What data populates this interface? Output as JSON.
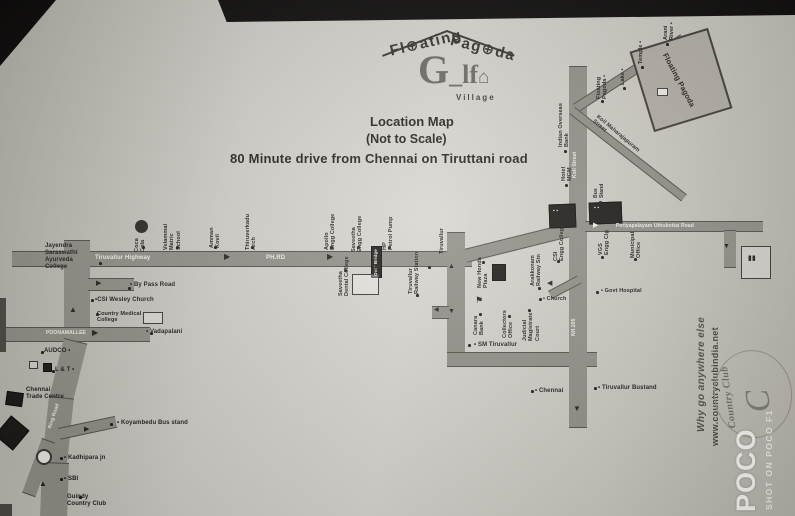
{
  "photo": {
    "watermark_big": "POCO",
    "watermark_small": "SHOT ON POCO F1"
  },
  "header": {
    "brand_word1": "Fl⊕ating",
    "brand_word2": "Pag⊕da",
    "logo_g": "G",
    "logo_underscore": "_",
    "logo_lf": "lf",
    "logo_house": "⌂",
    "logo_village": "Village",
    "title": "Location Map",
    "scale_note": "(Not to Scale)",
    "subtitle": "80 Minute drive from Chennai on Tiruttani road"
  },
  "promo": {
    "tagline": "Why go anywhere else",
    "website": "www.countryclubindia.net",
    "logo_swirl": "C",
    "logo_name": "Country Club"
  },
  "map": {
    "roads": [
      [
        12,
        251,
        460,
        16,
        0
      ],
      [
        464,
        249,
        120,
        14,
        -14
      ],
      [
        64,
        240,
        26,
        102,
        0
      ],
      [
        88,
        278,
        46,
        13,
        0
      ],
      [
        0,
        327,
        150,
        15,
        0
      ],
      [
        64,
        338,
        24,
        62,
        14
      ],
      [
        49,
        396,
        25,
        68,
        6
      ],
      [
        42,
        462,
        27,
        56,
        2
      ],
      [
        42,
        438,
        14,
        58,
        20
      ],
      [
        58,
        428,
        58,
        12,
        -12
      ],
      [
        447,
        232,
        18,
        122,
        0
      ],
      [
        447,
        352,
        150,
        15,
        0
      ],
      [
        569,
        66,
        18,
        362,
        0
      ],
      [
        585,
        221,
        178,
        11,
        0
      ],
      [
        573,
        104,
        128,
        10,
        -33
      ],
      [
        575,
        107,
        142,
        9,
        38
      ],
      [
        724,
        230,
        12,
        38,
        0
      ],
      [
        432,
        306,
        17,
        13,
        0
      ],
      [
        548,
        291,
        33,
        9,
        -28
      ]
    ],
    "shapes": [
      [
        549,
        204,
        27,
        24,
        "s-dark",
        -2
      ],
      [
        589,
        202,
        33,
        22,
        "s-dark",
        -2
      ],
      [
        135,
        220,
        13,
        13,
        "s-circledark",
        0
      ],
      [
        640,
        38,
        82,
        84,
        "s-site",
        -17
      ],
      [
        657,
        88,
        11,
        8,
        "s-white",
        0
      ],
      [
        371,
        246,
        11,
        32,
        "s-dark",
        0
      ],
      [
        352,
        274,
        27,
        21,
        "s-outline",
        0
      ],
      [
        492,
        264,
        14,
        17,
        "s-dark",
        0
      ],
      [
        6,
        392,
        17,
        14,
        "s-dark",
        8
      ],
      [
        741,
        246,
        30,
        33,
        "s-outline",
        0
      ],
      [
        29,
        361,
        9,
        8,
        "s-outline",
        0
      ],
      [
        43,
        363,
        9,
        9,
        "s-dark",
        0
      ],
      [
        36,
        449,
        16,
        16,
        "s-circle",
        0
      ],
      [
        143,
        312,
        20,
        12,
        "s-outline",
        0
      ],
      [
        0,
        298,
        6,
        54,
        "s-dim",
        0
      ],
      [
        0,
        420,
        24,
        26,
        "s-dark",
        40
      ],
      [
        0,
        504,
        12,
        12,
        "s-dim",
        0
      ]
    ],
    "labels": [
      {
        "t": "Tiruvallur Highway",
        "x": 95,
        "y": 255,
        "s": 6,
        "c": "wt"
      },
      {
        "t": "PH.RD",
        "x": 266,
        "y": 255,
        "s": 6,
        "c": "wt"
      },
      {
        "t": "POONAMALLEE",
        "x": 46,
        "y": 331,
        "s": 5,
        "c": "wt"
      },
      {
        "t": "Ring Road",
        "x": 48,
        "y": 428,
        "r": -72,
        "s": 5,
        "c": "wt"
      },
      {
        "t": "Koil Street",
        "x": 573,
        "y": 178,
        "r": -90,
        "s": 5,
        "c": "wt"
      },
      {
        "t": "NH.205",
        "x": 572,
        "y": 336,
        "r": -90,
        "s": 5,
        "c": "wt"
      },
      {
        "t": "Periyapalayam Uthukottai Road",
        "x": 616,
        "y": 224,
        "s": 5,
        "c": "wt"
      },
      {
        "t": "Over Bridge",
        "x": 373,
        "y": 276,
        "r": -90,
        "s": 4.5,
        "c": "wt"
      },
      {
        "t": "Jayendra\nSaraswathi\nAyurveda\nCollege",
        "x": 45,
        "y": 243,
        "s": 6
      },
      {
        "t": "• By Pass Road",
        "x": 130,
        "y": 282,
        "s": 6
      },
      {
        "t": "•CSI Wesley Church",
        "x": 95,
        "y": 297,
        "s": 6
      },
      {
        "t": "Country Medical\nCollege",
        "x": 97,
        "y": 311,
        "s": 5.5
      },
      {
        "t": "• Vadapalani",
        "x": 146,
        "y": 329,
        "s": 6
      },
      {
        "t": "AUDCO •",
        "x": 44,
        "y": 348,
        "s": 6
      },
      {
        "t": "L & T •",
        "x": 55,
        "y": 367,
        "s": 6
      },
      {
        "t": "Chennai\nTrade Centre",
        "x": 26,
        "y": 387,
        "s": 6
      },
      {
        "t": "• Koyambedu Bus stand",
        "x": 117,
        "y": 420,
        "s": 6
      },
      {
        "t": "• Kadhipara jn",
        "x": 64,
        "y": 455,
        "s": 6
      },
      {
        "t": "• SBI",
        "x": 64,
        "y": 476,
        "s": 6
      },
      {
        "t": "Guindy\nCountry Club",
        "x": 67,
        "y": 494,
        "s": 6
      },
      {
        "t": "Coca\nCola",
        "x": 134,
        "y": 252,
        "r": -90,
        "s": 5.5
      },
      {
        "t": "Velammal\nMatric\nSchool",
        "x": 163,
        "y": 250,
        "r": -90,
        "s": 5.5
      },
      {
        "t": "Amman\nKovil",
        "x": 209,
        "y": 248,
        "r": -90,
        "s": 5.5
      },
      {
        "t": "Thiruverkadu\nArch",
        "x": 245,
        "y": 250,
        "r": -90,
        "s": 5.5
      },
      {
        "t": "Apollo\nEngg College",
        "x": 324,
        "y": 250,
        "r": -90,
        "s": 5.5
      },
      {
        "t": "Saveetha\nEngg College",
        "x": 351,
        "y": 252,
        "r": -90,
        "s": 5.5
      },
      {
        "t": "HP\nPetrol Pump",
        "x": 382,
        "y": 250,
        "r": -90,
        "s": 5.5
      },
      {
        "t": "Saveetha\nDental College",
        "x": 338,
        "y": 296,
        "r": -90,
        "s": 5.5
      },
      {
        "t": "Tiruvallur\nRailway Station",
        "x": 408,
        "y": 294,
        "r": -90,
        "s": 5.5
      },
      {
        "t": "Tiruvallur",
        "x": 439,
        "y": 254,
        "r": -90,
        "s": 5.5
      },
      {
        "t": "New Honda\nPlaza",
        "x": 477,
        "y": 288,
        "r": -90,
        "s": 5.5
      },
      {
        "t": "Canara\nBank",
        "x": 473,
        "y": 335,
        "r": -90,
        "s": 5.5
      },
      {
        "t": "Collectors\nOffice",
        "x": 502,
        "y": 338,
        "r": -90,
        "s": 5.5
      },
      {
        "t": "Judicial\nMagistrate\nCourt",
        "x": 522,
        "y": 341,
        "r": -90,
        "s": 5.5
      },
      {
        "t": "Arakkonam\nRailway Stn",
        "x": 530,
        "y": 286,
        "r": -90,
        "s": 5.5
      },
      {
        "t": "CSI\nEngg College",
        "x": 553,
        "y": 261,
        "r": -90,
        "s": 5.5
      },
      {
        "t": "VGS\nEngg Clg",
        "x": 598,
        "y": 255,
        "r": -90,
        "s": 5.5
      },
      {
        "t": "Municipal\nOffice",
        "x": 630,
        "y": 258,
        "r": -90,
        "s": 5.5
      },
      {
        "t": "• SM Tiruvallur",
        "x": 474,
        "y": 342,
        "s": 6
      },
      {
        "t": "• Chennai",
        "x": 535,
        "y": 388,
        "s": 6
      },
      {
        "t": "• Tiruvallur Bustand",
        "x": 598,
        "y": 385,
        "s": 6
      },
      {
        "t": "• Govt Hospital",
        "x": 601,
        "y": 288,
        "s": 5.5
      },
      {
        "t": "• Church",
        "x": 543,
        "y": 296,
        "s": 5.5
      },
      {
        "t": "Indian Overseas\nBank",
        "x": 558,
        "y": 147,
        "r": -90,
        "s": 5.5
      },
      {
        "t": "Hotel\nMGM",
        "x": 561,
        "y": 181,
        "r": -90,
        "s": 5.5
      },
      {
        "t": "Bus\nStand",
        "x": 594,
        "y": 198,
        "r": -90,
        "s": 5
      },
      {
        "t": "Floating\nPagoda •",
        "x": 596,
        "y": 99,
        "r": -90,
        "s": 5.5
      },
      {
        "t": "Lake •",
        "x": 620,
        "y": 85,
        "r": -90,
        "s": 5.5
      },
      {
        "t": "Temple •",
        "x": 638,
        "y": 64,
        "r": -90,
        "s": 5.5
      },
      {
        "t": "Arani\nRiver •",
        "x": 663,
        "y": 40,
        "r": -90,
        "s": 5.5
      },
      {
        "t": "Koil Maharajapuram\nStreet",
        "x": 599,
        "y": 114,
        "r": 40,
        "s": 5.5
      },
      {
        "t": "Floating Pagoda",
        "x": 668,
        "y": 52,
        "r": 62,
        "s": 7.5,
        "w": 700
      },
      {
        "t": "▶",
        "x": 224,
        "y": 252,
        "s": 8,
        "c": "arr"
      },
      {
        "t": "▶",
        "x": 327,
        "y": 252,
        "s": 8,
        "c": "arr"
      },
      {
        "t": "▶",
        "x": 96,
        "y": 280,
        "s": 7,
        "c": "arr"
      },
      {
        "t": "▶",
        "x": 92,
        "y": 328,
        "s": 8,
        "c": "arr"
      },
      {
        "t": "▶",
        "x": 84,
        "y": 426,
        "s": 7,
        "c": "arr"
      },
      {
        "t": "▲",
        "x": 69,
        "y": 305,
        "s": 8,
        "c": "arr"
      },
      {
        "t": "▲",
        "x": 39,
        "y": 479,
        "s": 8,
        "c": "arr"
      },
      {
        "t": "▲",
        "x": 448,
        "y": 263,
        "s": 7,
        "c": "arr"
      },
      {
        "t": "▼",
        "x": 448,
        "y": 308,
        "s": 7,
        "c": "arr"
      },
      {
        "t": "▼",
        "x": 573,
        "y": 404,
        "s": 8,
        "c": "arr"
      },
      {
        "t": "▼",
        "x": 723,
        "y": 243,
        "s": 7,
        "c": "arr"
      },
      {
        "t": "◀",
        "x": 547,
        "y": 280,
        "s": 7,
        "c": "arr"
      },
      {
        "t": "◀",
        "x": 434,
        "y": 307,
        "s": 6,
        "c": "arr"
      },
      {
        "t": "▶",
        "x": 593,
        "y": 222,
        "s": 7,
        "c": "wt"
      },
      {
        "t": "⚑",
        "x": 373,
        "y": 263,
        "s": 9
      },
      {
        "t": "⚑",
        "x": 475,
        "y": 295,
        "s": 9
      },
      {
        "t": "▪ ▪",
        "x": 553,
        "y": 209,
        "s": 5,
        "c": "wt"
      },
      {
        "t": "▪ ▪",
        "x": 594,
        "y": 206,
        "s": 5,
        "c": "wt"
      },
      {
        "t": "▮▮",
        "x": 748,
        "y": 255,
        "s": 7
      }
    ],
    "dots": [
      [
        99,
        262
      ],
      [
        142,
        246
      ],
      [
        176,
        246
      ],
      [
        214,
        246
      ],
      [
        251,
        246
      ],
      [
        330,
        246
      ],
      [
        357,
        246
      ],
      [
        388,
        246
      ],
      [
        128,
        287
      ],
      [
        91,
        299
      ],
      [
        150,
        332
      ],
      [
        110,
        423
      ],
      [
        60,
        457
      ],
      [
        60,
        478
      ],
      [
        79,
        496
      ],
      [
        41,
        351
      ],
      [
        52,
        370
      ],
      [
        468,
        344
      ],
      [
        531,
        390
      ],
      [
        594,
        387
      ],
      [
        596,
        291
      ],
      [
        539,
        298
      ],
      [
        482,
        261
      ],
      [
        479,
        313
      ],
      [
        508,
        315
      ],
      [
        528,
        309
      ],
      [
        538,
        287
      ],
      [
        557,
        260
      ],
      [
        601,
        256
      ],
      [
        634,
        258
      ],
      [
        564,
        150
      ],
      [
        565,
        184
      ],
      [
        599,
        201
      ],
      [
        601,
        100
      ],
      [
        623,
        87
      ],
      [
        641,
        66
      ],
      [
        666,
        43
      ],
      [
        344,
        269
      ],
      [
        416,
        294
      ],
      [
        428,
        266
      ],
      [
        96,
        313
      ]
    ]
  }
}
